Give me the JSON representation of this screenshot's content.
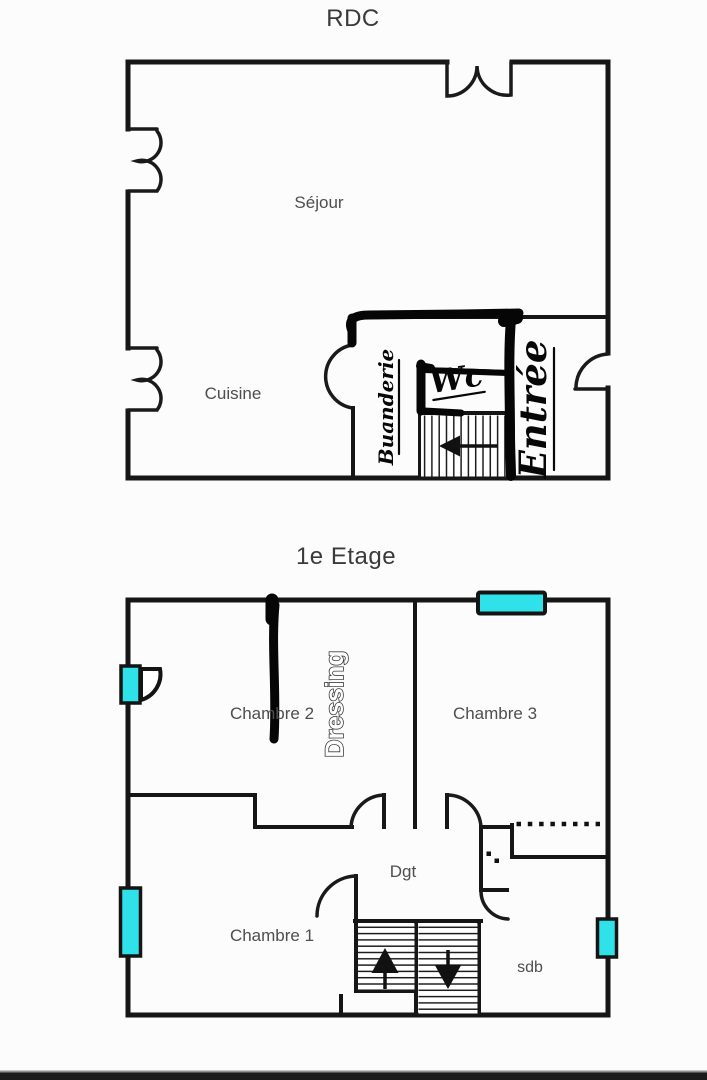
{
  "colors": {
    "wall": "#161616",
    "label_text": "#4e4e4e",
    "title_text": "#3a3a3a",
    "annotation_ink": "#070707",
    "window_fill": "#2fe1e9",
    "photo_bar": "#1b1b1b"
  },
  "icons": {
    "rdc_stairs_arrow": "left-arrow",
    "etage_left_flight_arrow": "up-arrow",
    "etage_right_flight_arrow": "down-arrow",
    "window_marker": "cyan-rectangle"
  },
  "rdc": {
    "title": "RDC",
    "rooms": {
      "sejour": "Séjour",
      "cuisine": "Cuisine",
      "buanderie": "Buanderie",
      "wc": "Wc",
      "entree": "Entrée"
    }
  },
  "etage": {
    "title": "1e Etage",
    "rooms": {
      "chambre1": "Chambre 1",
      "chambre2": "Chambre 2",
      "chambre3": "Chambre 3",
      "dressing": "Dressing",
      "dgt": "Dgt",
      "sdb": "sdb"
    }
  }
}
